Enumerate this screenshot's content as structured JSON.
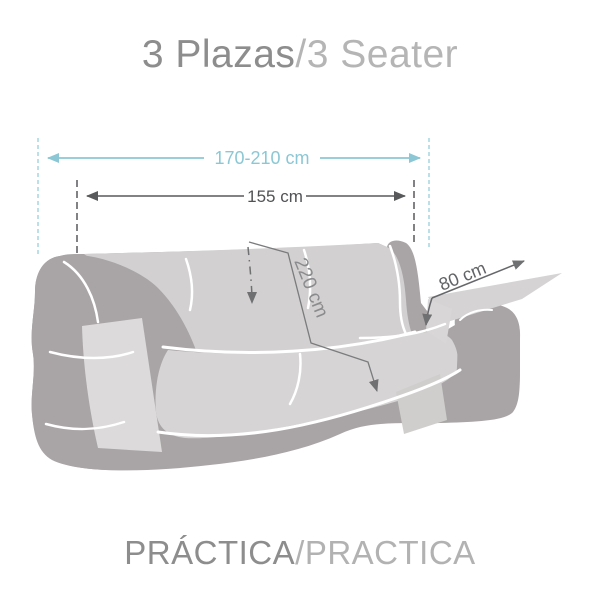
{
  "title": {
    "text_primary": "3 Plazas",
    "text_secondary": "/3 Seater"
  },
  "footer": {
    "text_primary": "PRÁCTICA",
    "text_secondary": "/PRACTICA"
  },
  "dimensions": {
    "total_width": {
      "label": "170-210 cm"
    },
    "inner_width": {
      "label": "155 cm"
    },
    "cover_length": {
      "label": "220 cm"
    },
    "arm_depth": {
      "label": "80 cm"
    }
  },
  "colors": {
    "accent_cyan": "#8bc7d5",
    "dim_gray": "#58595b",
    "mid_gray": "#6f7072",
    "sofa_body": "#a9a5a6",
    "sofa_cover": "#d2d0d0",
    "sofa_seat": "#d6d4d4",
    "title_primary": "#8d8d8d",
    "title_secondary": "#b5b5b5",
    "background": "#ffffff"
  }
}
